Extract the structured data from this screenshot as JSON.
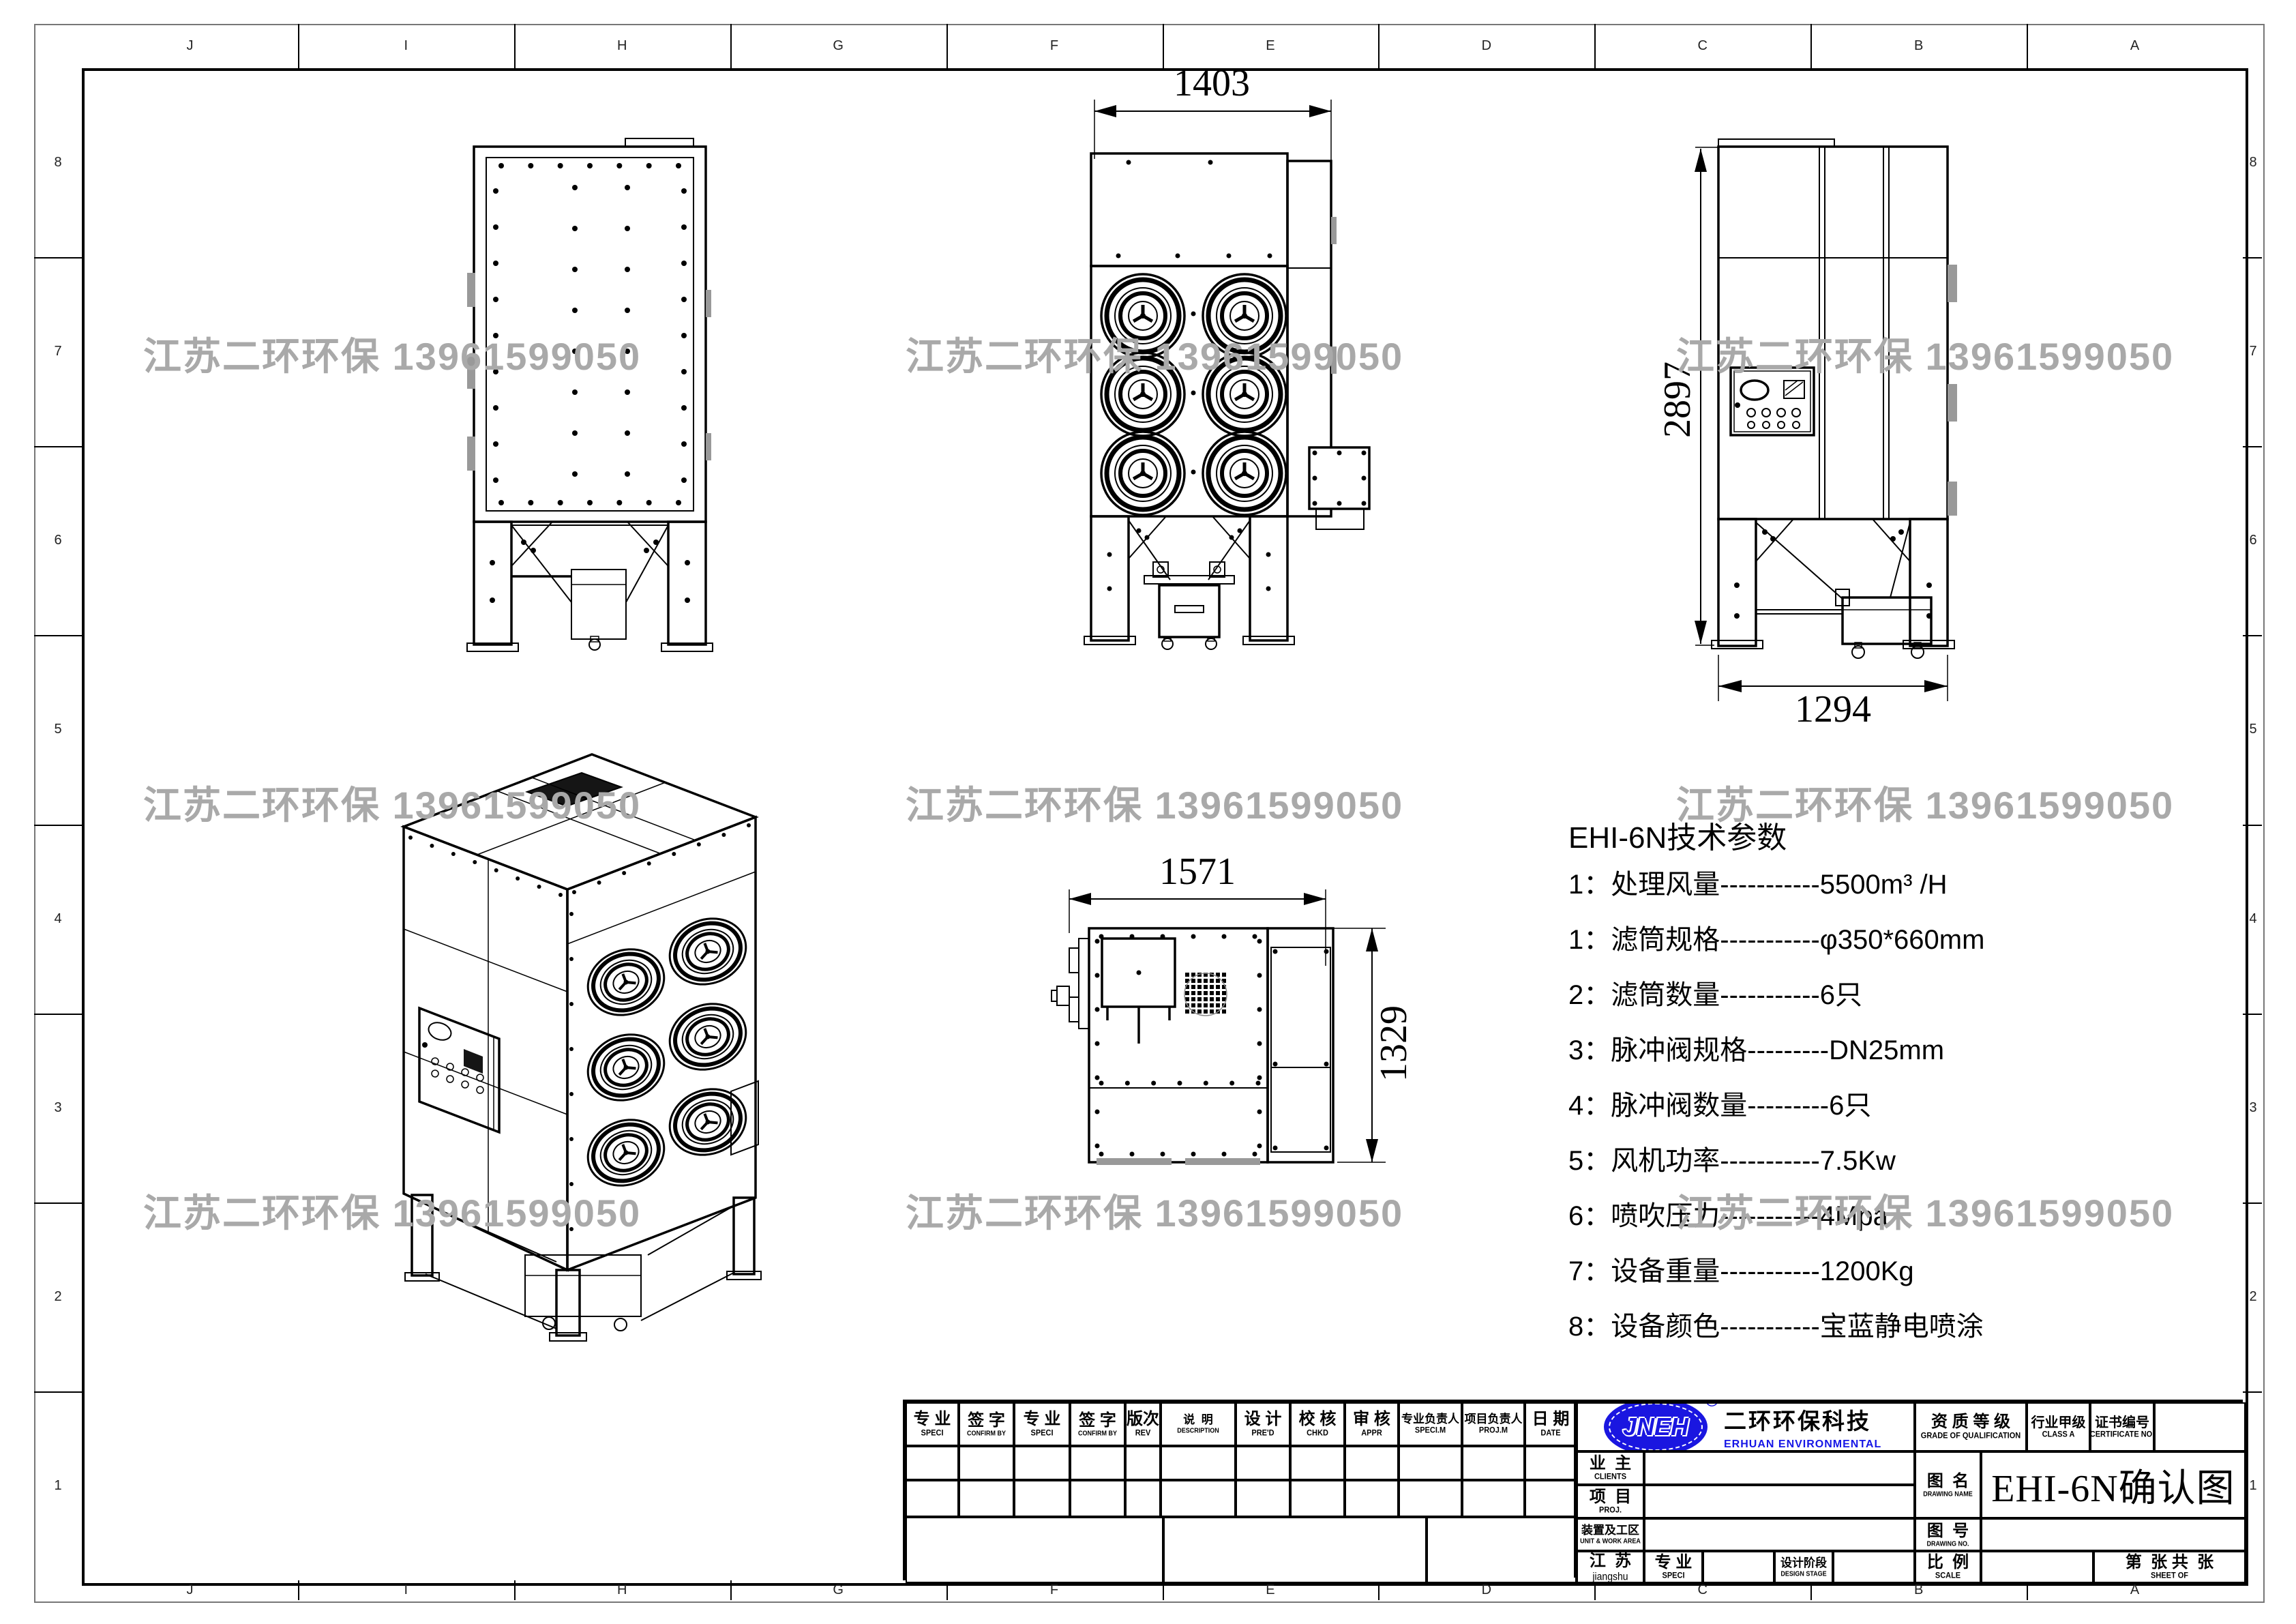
{
  "watermark": {
    "text": "江苏二环环保 13961599050",
    "color": "#a9a9a9"
  },
  "frame": {
    "top_letters": [
      "J",
      "I",
      "H",
      "G",
      "F",
      "E",
      "D",
      "C",
      "B",
      "A"
    ],
    "side_numbers": [
      "8",
      "7",
      "6",
      "5",
      "4",
      "3",
      "2",
      "1"
    ]
  },
  "dimensions": {
    "front_width": "1403",
    "side_height": "2897",
    "side_width": "1294",
    "top_width": "1571",
    "top_depth": "1329"
  },
  "tech_params": {
    "title": "EHI-6N技术参数",
    "items": [
      "1：处理风量-----------5500m³ /H",
      "1：滤筒规格-----------φ350*660mm",
      "2：滤筒数量-----------6只",
      "3：脉冲阀规格---------DN25mm",
      "4：脉冲阀数量---------6只",
      "5：风机功率-----------7.5Kw",
      "6：喷吹压力-----------4Mpa",
      "7：设备重量-----------1200Kg",
      "8：设备颜色-----------宝蓝静电喷涂"
    ]
  },
  "title_block": {
    "rev_columns": [
      {
        "zh": "专 业",
        "en": "SPECI"
      },
      {
        "zh": "签 字",
        "en": "CONFIRM BY"
      },
      {
        "zh": "专 业",
        "en": "SPECI"
      },
      {
        "zh": "签 字",
        "en": "CONFIRM BY"
      },
      {
        "zh": "版次",
        "en": "REV"
      },
      {
        "zh": "说  明",
        "en": "DESCRIPTION"
      },
      {
        "zh": "设 计",
        "en": "PRE'D"
      },
      {
        "zh": "校 核",
        "en": "CHKD"
      },
      {
        "zh": "审 核",
        "en": "APPR"
      },
      {
        "zh": "专业负责人",
        "en": "SPECI.M"
      },
      {
        "zh": "项目负责人",
        "en": "PROJ.M"
      },
      {
        "zh": "日 期",
        "en": "DATE"
      }
    ],
    "company": {
      "logo": "JNEH",
      "reg": "®",
      "zh": "二环环保科技",
      "en": "ERHUAN ENVIRONMENTAL"
    },
    "qualification": {
      "zh": "资 质 等 级",
      "en": "GRADE OF QUALIFICATION"
    },
    "class_a": {
      "zh": "行业甲级",
      "en": "CLASS A"
    },
    "certificate": {
      "zh": "证书编号",
      "en": "CERTIFICATE NO."
    },
    "clients": {
      "zh": "业  主",
      "en": "CLIENTS"
    },
    "project": {
      "zh": "项  目",
      "en": "PROJ."
    },
    "unit": {
      "zh": "装置及工区",
      "en": "UNIT & WORK AREA"
    },
    "region": {
      "zh": "江  苏",
      "en": "jiangshu"
    },
    "speci": {
      "zh": "专 业",
      "en": "SPECI"
    },
    "design_stage": {
      "zh": "设计阶段",
      "en": "DESIGN STAGE"
    },
    "drawing_name": {
      "zh": "图  名",
      "en": "DRAWING NAME",
      "value": "EHI-6N确认图"
    },
    "drawing_no": {
      "zh": "图  号",
      "en": "DRAWING NO."
    },
    "scale": {
      "zh": "比  例",
      "en": "SCALE"
    },
    "sheet": {
      "zh": "第  张 共  张",
      "en": "SHEET OF"
    }
  }
}
